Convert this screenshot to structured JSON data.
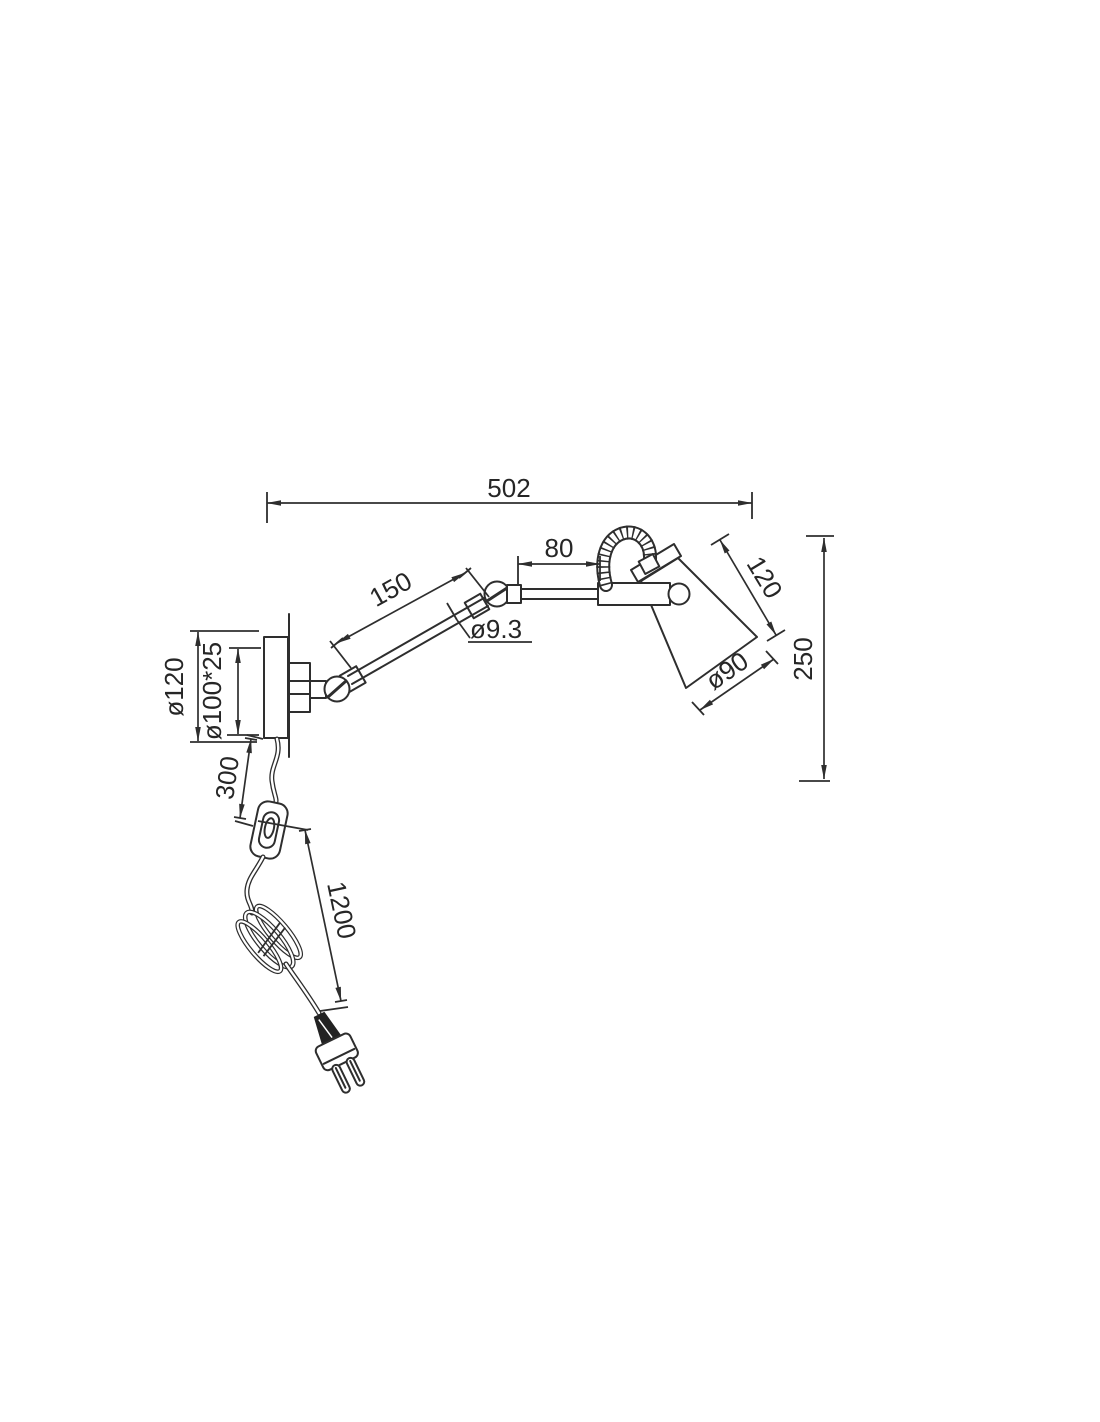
{
  "page": {
    "background_color": "#ffffff",
    "line_color": "#2e2e2e"
  },
  "drawing": {
    "type": "technical-dimension-drawing",
    "subject": "Wall-mounted swing-arm spot lamp with flex hose head, cord, inline switch and Euro plug",
    "units": "mm",
    "dimensions": {
      "overall_width": "502",
      "front_arm_length": "80",
      "rear_arm_length": "150",
      "arm_tube_diameter": "ø9.3",
      "shade_side_length": "120",
      "overall_height": "250",
      "shade_opening_diameter": "ø90",
      "wall_plate_diameter": "ø120",
      "wall_plate_body": "ø100*25",
      "cord_wall_to_switch": "300",
      "cord_switch_to_plug": "1200"
    }
  }
}
